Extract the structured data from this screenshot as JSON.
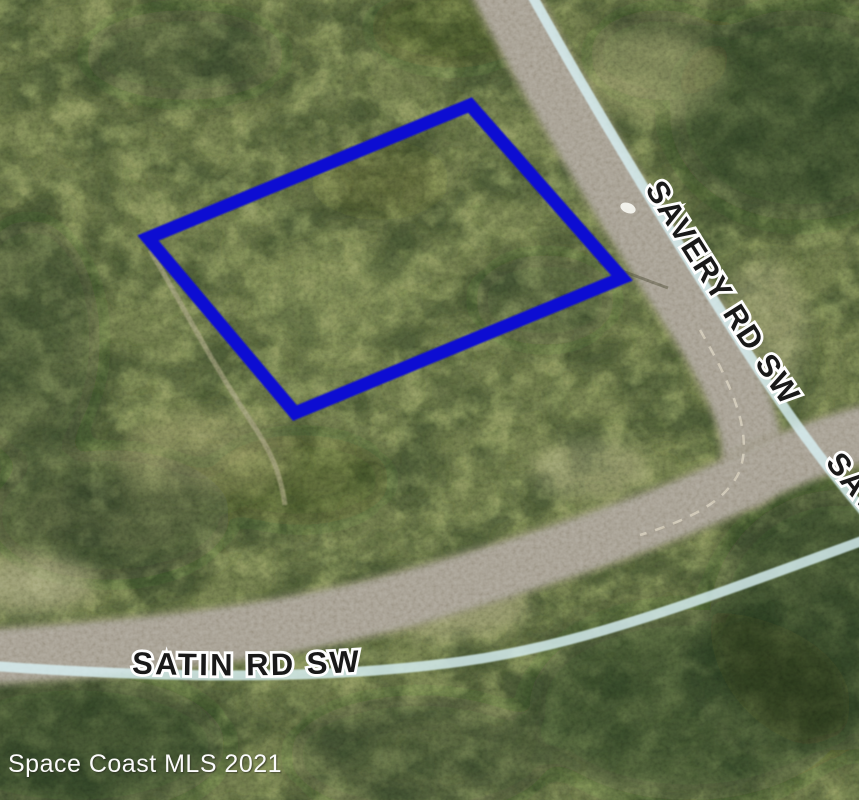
{
  "map": {
    "labels": {
      "savery_road": "SAVERY RD SW",
      "savery_road_repeat": "SAVERY RD SW",
      "satin_road": "SATIN RD SW"
    },
    "watermark": "Space Coast MLS 2021",
    "colors": {
      "parcel_outline": "#0f11d2",
      "road_overlay": "#d8f0f4"
    }
  }
}
